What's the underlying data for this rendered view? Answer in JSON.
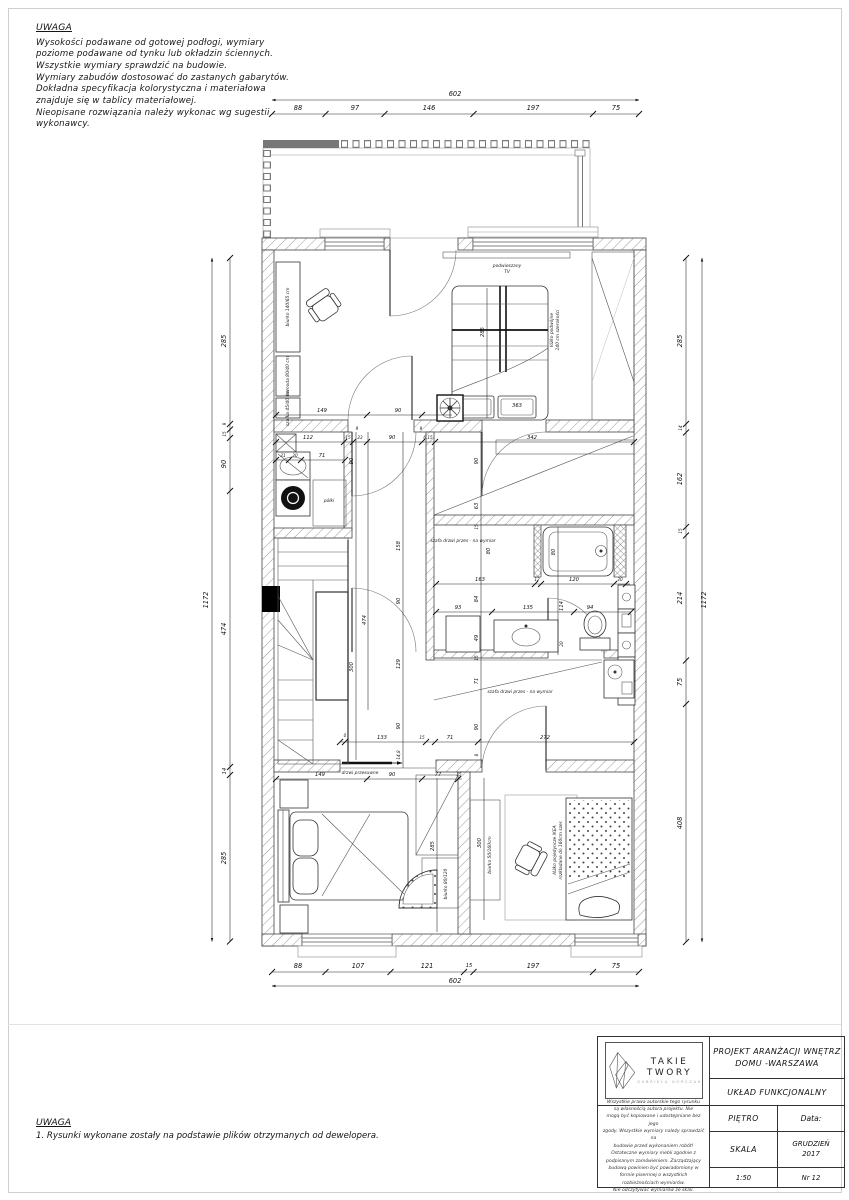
{
  "notes_top": {
    "title": "UWAGA",
    "lines": [
      "Wysokości podawane od gotowej podłogi, wymiary",
      "poziome podawane od tynku lub okładzin ściennych.",
      "Wszystkie wymiary sprawdzić na budowie.",
      "Wymiary zabudów dostosować do zastanych gabarytów.",
      "Dokładna specyfikacja kolorystyczna i materiałowa",
      "znajduje się w tablicy materiałowej.",
      "Nieopisane rozwiązania należy wykonac wg sugestii",
      "wykonawcy."
    ]
  },
  "notes_bottom": {
    "title": "UWAGA",
    "lines": [
      "1. Rysunki wykonane zostały na podstawie plików otrzymanych od dewelopera."
    ]
  },
  "dims": {
    "top": {
      "total": "602",
      "segments": [
        "88",
        "97",
        "146",
        "197",
        "75"
      ]
    },
    "bottom": {
      "total": "602",
      "segments": [
        "88",
        "107",
        "121",
        "15",
        "197",
        "75"
      ]
    },
    "left": {
      "total": "1172",
      "segments": [
        "285",
        "9",
        "15",
        "90",
        "474",
        "14",
        "285"
      ]
    },
    "right": {
      "total": "1172",
      "segments": [
        "285",
        "14",
        "162",
        "15",
        "214",
        "75",
        "408"
      ]
    },
    "interior": {
      "top_room": [
        "149",
        "90",
        "285",
        "363"
      ],
      "row_mid": [
        "112",
        "15",
        "23",
        "90",
        "6,15",
        "342"
      ],
      "row_utility": [
        "21",
        "20",
        "71"
      ],
      "jambs": [
        "9",
        "9"
      ],
      "corridor_left": [
        "90",
        "300"
      ],
      "corridor_mid": [
        "474"
      ],
      "corridor_right": [
        "158",
        "90",
        "129",
        "90",
        "14,8"
      ],
      "right_col": [
        "90",
        "63",
        "15",
        "80",
        "84",
        "49",
        "15",
        "71",
        "90",
        "8"
      ],
      "bath_col": [
        "80",
        "114",
        "20"
      ],
      "bath_row1": [
        "163",
        "12",
        "120",
        "20"
      ],
      "bath_row2": [
        "93",
        "135",
        "94"
      ],
      "row_lower": [
        "0",
        "133",
        "15",
        "71",
        "272"
      ],
      "row_bottom": [
        "149",
        "90",
        "77",
        "15"
      ],
      "room_bl": [
        "285"
      ],
      "room_br": [
        "300"
      ]
    }
  },
  "labels": {
    "tv_line1": "podwieszany",
    "tv_line2": "TV",
    "desk_top": "biurko 140/65 cm",
    "dresser": "komoda 80/40 cm",
    "cabinet": "szafka 45/40 cm",
    "bed_double_1": "łóżko podwójne",
    "bed_double_2": "140 cm szerokości",
    "shelves": "półki",
    "wardrobe_1": "szafa drzwi przes - na wymiar",
    "wardrobe_2": "szafa drzwi przes - na wymiar",
    "sliding_door": "drzwi przesuwne",
    "desk_bl": "biurko 80/120",
    "desk_br": "biurko 50/160cm",
    "bed_single_1": "łóżko pojedyncze IKEA",
    "bed_single_2": "rozkładane do 160cm szer."
  },
  "title_block": {
    "project_line1": "PROJEKT ARANŻACJI WNĘTRZ",
    "project_line2": "DOMU -WARSZAWA",
    "drawing_title": "UKŁAD FUNKCJONALNY",
    "field_stage": "PIĘTRO",
    "field_date_label": "Data:",
    "field_scale_label": "SKALA",
    "date_line1": "GRUDZIEŃ",
    "date_line2": "2017",
    "scale_value": "1:50",
    "number_value": "Nr 12",
    "logo_text": "TAKIE TWORY",
    "logo_sub": "GABRIELA GORCZAK",
    "legal_lines": [
      "Wszystkie prawa autorskie tego rysunku",
      "są własnością autora projektu. Nie",
      "mogą być kopiowane i udostępniane bez jego",
      "zgody. Wszystkie wymiary należy sprawdzić na",
      "budowie przed wykonaniem robót!",
      "Ostateczne wymiary mebli zgodnie z",
      "podpisanym zamówieniem. Zarządzający",
      "budową powinien być powiadomiony w",
      "formie pisemnej o wszystkich",
      "rozbieżnościach wymiarów.",
      "Nie odczytywać wymiarów ze skali."
    ]
  }
}
